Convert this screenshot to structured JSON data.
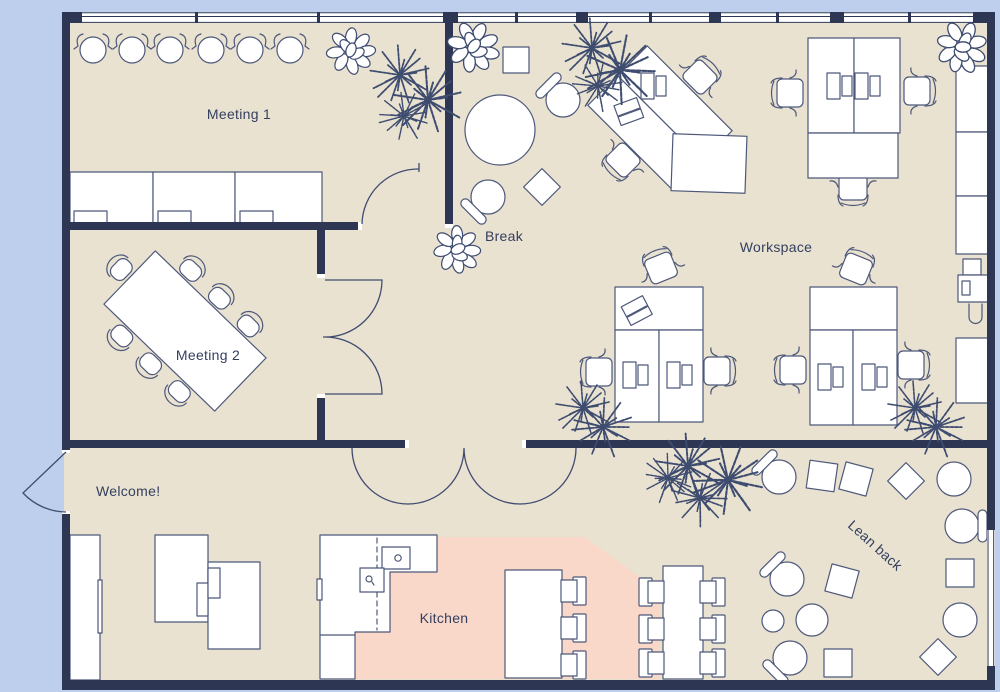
{
  "colors": {
    "background": "#becfee",
    "floor": "#e9e2d1",
    "wall": "#2d3754",
    "kitchen_floor": "#f9d8ca",
    "furniture_stroke": "#4d587a",
    "plant": "#3e4c70",
    "text": "#333f5f"
  },
  "rooms": {
    "meeting1": {
      "label": "Meeting 1"
    },
    "meeting2": {
      "label": "Meeting 2"
    },
    "break_area": {
      "label": "Break"
    },
    "workspace": {
      "label": "Workspace"
    },
    "welcome": {
      "label": "Welcome!"
    },
    "kitchen": {
      "label": "Kitchen"
    },
    "lean_back": {
      "label": "Lean back"
    }
  }
}
